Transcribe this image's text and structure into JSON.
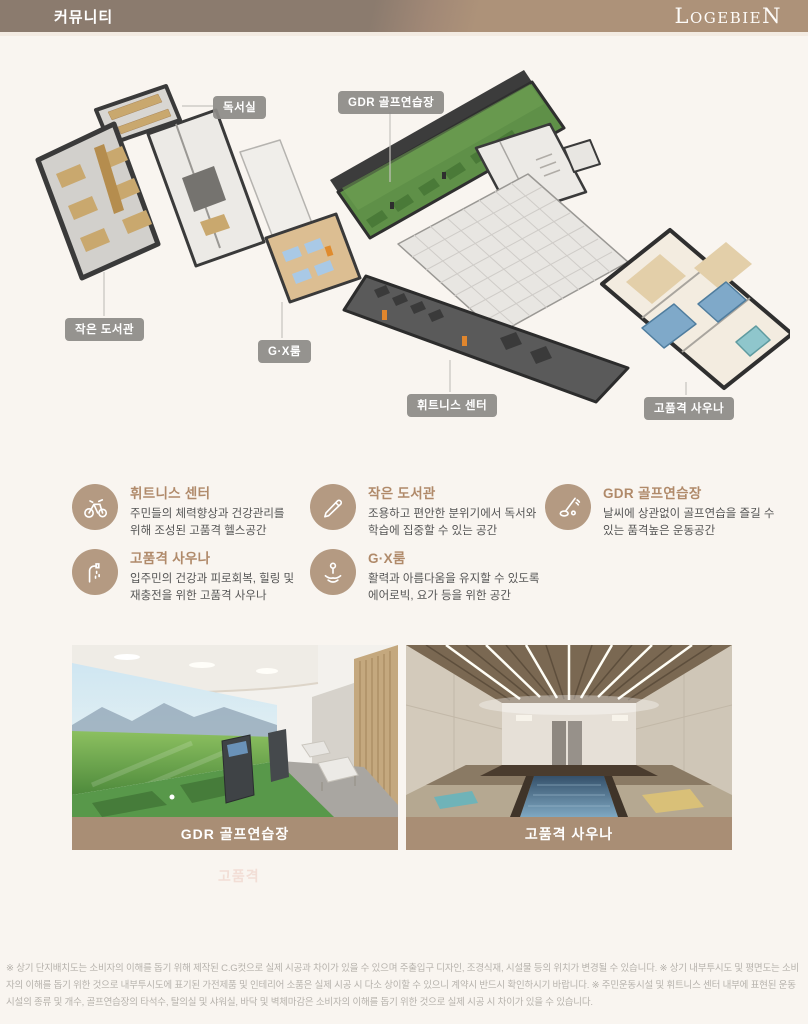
{
  "header": {
    "title": "커뮤니티",
    "logo": "LogebieN"
  },
  "floorplan": {
    "labels": [
      {
        "text": "독서실"
      },
      {
        "text": "GDR 골프연습장"
      },
      {
        "text": "작은 도서관"
      },
      {
        "text": "G·X룸"
      },
      {
        "text": "휘트니스 센터"
      },
      {
        "text": "고품격 사우나"
      }
    ]
  },
  "features": {
    "items": [
      {
        "icon": "exercise-bike-icon",
        "title": "휘트니스 센터",
        "desc": "주민들의 체력향상과 건강관리를 위해 조성된 고품격 헬스공간"
      },
      {
        "icon": "pencil-icon",
        "title": "작은 도서관",
        "desc": "조용하고 편안한 분위기에서 독서와 학습에 집중할 수 있는 공간"
      },
      {
        "icon": "golf-icon",
        "title": "GDR 골프연습장",
        "desc": "날씨에 상관없이 골프연습을 즐길 수 있는 품격높은 운동공간"
      },
      {
        "icon": "shower-icon",
        "title": "고품격 사우나",
        "desc": "입주민의 건강과 피로회복, 힐링 및 재충전을 위한 고품격 사우나"
      },
      {
        "icon": "yoga-icon",
        "title": "G·X룸",
        "desc": "활력과 아름다움을 유지할 수 있도록 에어로빅, 요가 등을 위한 공간"
      }
    ]
  },
  "photos": [
    {
      "caption": "GDR 골프연습장"
    },
    {
      "caption": "고품격 사우나"
    }
  ],
  "watermark": {
    "text": "고품격"
  },
  "footer": {
    "text": "※ 상기 단지배치도는 소비자의 이해를 돕기 위해 제작된 C.G컷으로 실제 시공과 차이가 있을 수 있으며 주출입구 디자인, 조경식재, 시설물 등의 위치가 변경될 수 있습니다. ※ 상기 내부투시도 및 평면도는 소비자의 이해를 돕기 위한 것으로 내부투시도에 표기된 가전제품 및 인테리어 소품은 실제 시공 시 다소 상이할 수 있으니 계약시 반드시 확인하시기 바랍니다. ※ 주민운동시설 및 휘트니스 센터 내부에 표현된 운동시설의 종류 및 개수, 골프연습장의 타석수, 탈의실 및 샤워실, 바닥 및 벽체마감은 소비자의 이해를 돕기 위한 것으로 실제 시공 시 차이가 있을 수 있습니다."
  },
  "colors": {
    "header_left": "#8b7b6e",
    "header_right": "#ad9279",
    "accent_brown": "#a98e75",
    "feature_title": "#b08a6a",
    "icon_circle": "#b49a82",
    "label_chip": "#8d8b88",
    "golf_green": "#5f9048",
    "pool_blue": "#7fa9c9",
    "page_bg": "#f9f5f0"
  }
}
